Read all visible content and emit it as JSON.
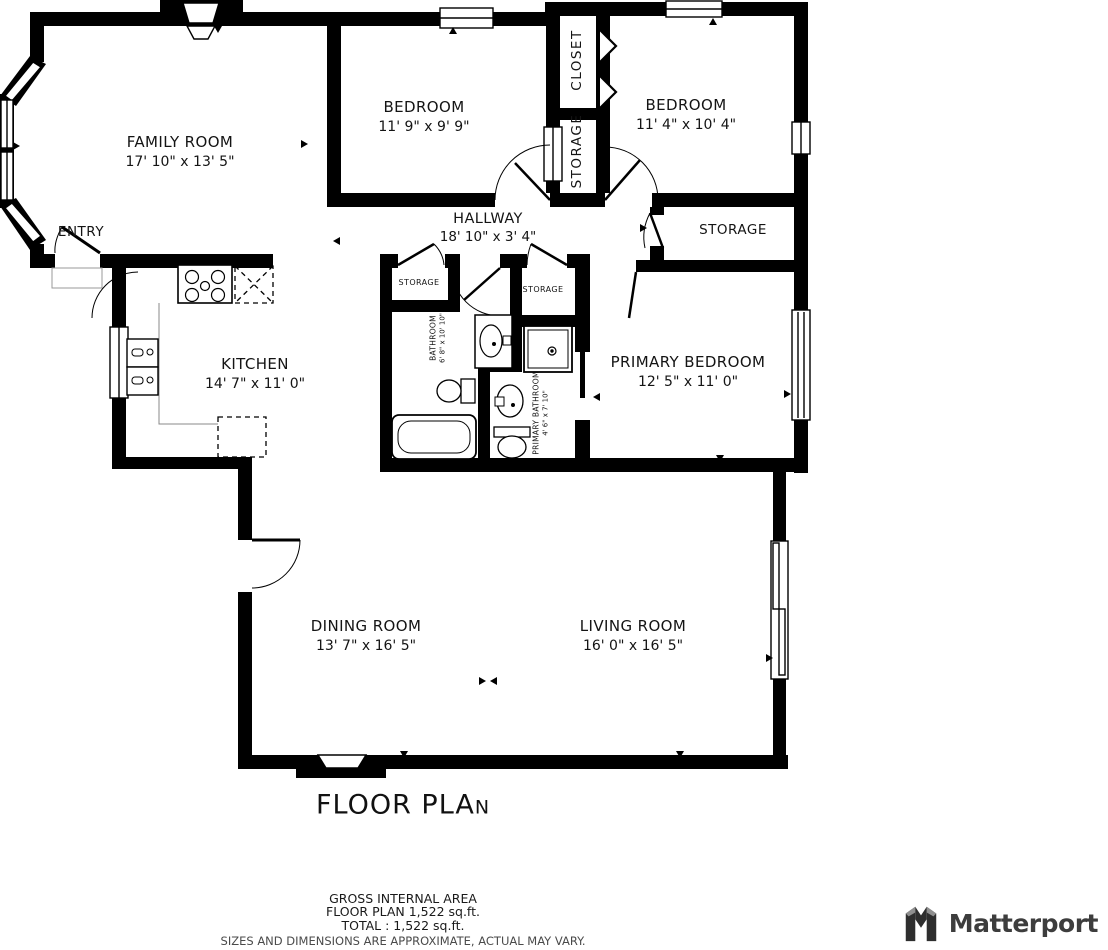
{
  "title": {
    "main": "FLOOR PLA",
    "small": "N"
  },
  "rooms": [
    {
      "id": "family-room",
      "name": "FAMILY ROOM",
      "dims": "17' 10\" x 13' 5\""
    },
    {
      "id": "entry",
      "name": "ENTRY",
      "dims": ""
    },
    {
      "id": "bedroom-top-middle",
      "name": "BEDROOM",
      "dims": "11' 9\" x 9' 9\""
    },
    {
      "id": "closet",
      "name": "CLOSET",
      "dims": ""
    },
    {
      "id": "storage-closet-strip",
      "name": "STORAGE",
      "dims": ""
    },
    {
      "id": "bedroom-top-right",
      "name": "BEDROOM",
      "dims": "11' 4\" x 10' 4\""
    },
    {
      "id": "hallway",
      "name": "HALLWAY",
      "dims": "18' 10\" x 3' 4\""
    },
    {
      "id": "storage-right",
      "name": "STORAGE",
      "dims": ""
    },
    {
      "id": "kitchen",
      "name": "KITCHEN",
      "dims": "14' 7\" x 11' 0\""
    },
    {
      "id": "storage-hall-1",
      "name": "STORAGE",
      "dims": ""
    },
    {
      "id": "storage-hall-2",
      "name": "STORAGE",
      "dims": ""
    },
    {
      "id": "bathroom",
      "name": "BATHROOM",
      "dims": "6' 8\" x 10' 10\""
    },
    {
      "id": "primary-bathroom",
      "name": "PRIMARY BATHROOM",
      "dims": "4' 6\" x 7' 10\""
    },
    {
      "id": "primary-bedroom",
      "name": "PRIMARY BEDROOM",
      "dims": "12' 5\" x 11' 0\""
    },
    {
      "id": "dining-room",
      "name": "DINING ROOM",
      "dims": "13' 7\" x 16' 5\""
    },
    {
      "id": "living-room",
      "name": "LIVING ROOM",
      "dims": "16' 0\" x 16' 5\""
    }
  ],
  "footer": {
    "gross_area_label": "GROSS INTERNAL AREA",
    "floor_plan_area": "FLOOR PLAN 1,522 sq.ft.",
    "total_area": "TOTAL :  1,522 sq.ft.",
    "disclaimer": "SIZES AND DIMENSIONS ARE APPROXIMATE, ACTUAL MAY VARY."
  },
  "brand": {
    "name": "Matterport"
  },
  "colors": {
    "wall": "#000000",
    "background": "#ffffff",
    "logo": "#3d3d3d",
    "disclaimer": "#4a4a4a"
  }
}
